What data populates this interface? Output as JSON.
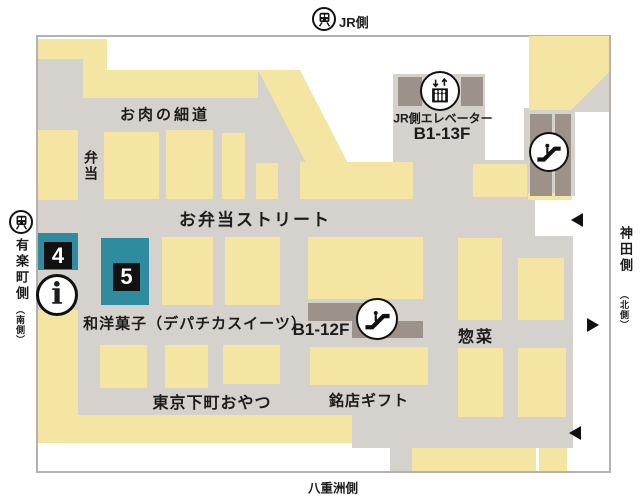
{
  "stations": {
    "jr": {
      "label": "JR側"
    },
    "yurakucho": {
      "label": "有楽町側",
      "sub": "（南側）"
    },
    "kanda": {
      "label": "神田側",
      "sub": "（北側）"
    },
    "yaesu": {
      "label": "八重洲側"
    }
  },
  "streets": {
    "oniku": "お肉の細道",
    "bento": "弁当",
    "obento_street": "お弁当ストリート",
    "wayo_sweets": "和洋菓子（デパチカスイーツ）",
    "shitamachi": "東京下町おやつ",
    "meiten_gift": "銘店ギフト",
    "souzai": "惣菜"
  },
  "facilities": {
    "elevator_label": "JR側エレベーター",
    "elevator_floors": "B1-13F",
    "escalator_floors": "B1-12F"
  },
  "markers": {
    "m4": "4",
    "m5": "5",
    "info": "i"
  },
  "colors": {
    "shop_block": "#f4e6a2",
    "corridor": "#d5d1cd",
    "facility_dark": "#9c9289",
    "highlight_teal": "#2f8b9e",
    "marker_black": "#111111"
  }
}
